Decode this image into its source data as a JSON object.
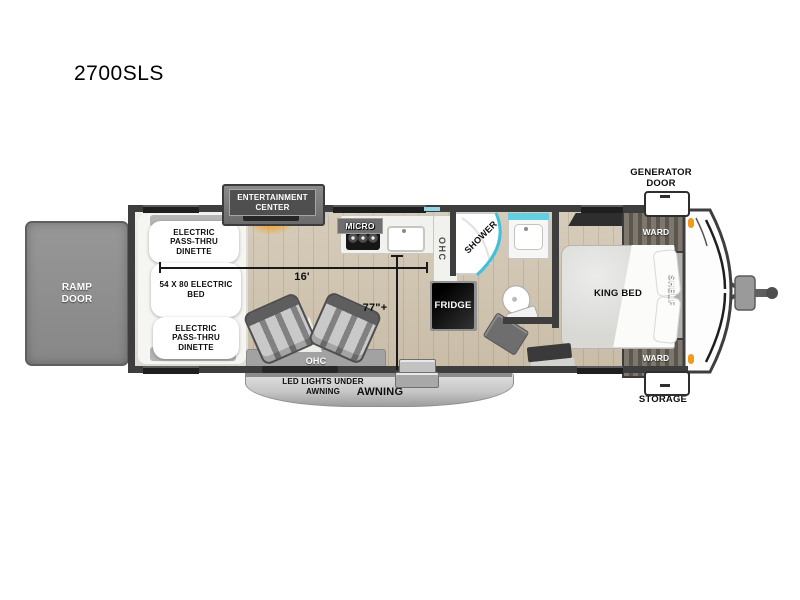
{
  "title": "2700SLS",
  "floorplan": {
    "ramp_door": "RAMP DOOR",
    "garage": {
      "dinette_top": "ELECTRIC PASS-THRU DINETTE",
      "electric_bed": "54 X 80 ELECTRIC BED",
      "dinette_bottom": "ELECTRIC PASS-THRU DINETTE"
    },
    "living": {
      "entertainment_center": "ENTERTAINMENT CENTER",
      "ohc": "OHC",
      "length_dim": "16'",
      "width_dim": "77\"+"
    },
    "kitchen": {
      "micro": "MICRO",
      "ohc": "OHC",
      "fridge": "FRIDGE"
    },
    "bath": {
      "shower": "SHOWER"
    },
    "bedroom": {
      "king_bed": "KING BED",
      "ward_top": "WARD",
      "ward_bottom": "WARD",
      "shelf": "SHELF"
    },
    "exterior": {
      "generator_door": "GENERATOR DOOR",
      "storage": "STORAGE",
      "awning": "AWNING",
      "led_lights": "LED LIGHTS UNDER AWNING"
    }
  },
  "colors": {
    "accent_cyan": "#3ec1dc",
    "glow_orange": "#f09a1e",
    "wall": "#3e3e3e",
    "floor_wood": "#cdc2ae"
  }
}
